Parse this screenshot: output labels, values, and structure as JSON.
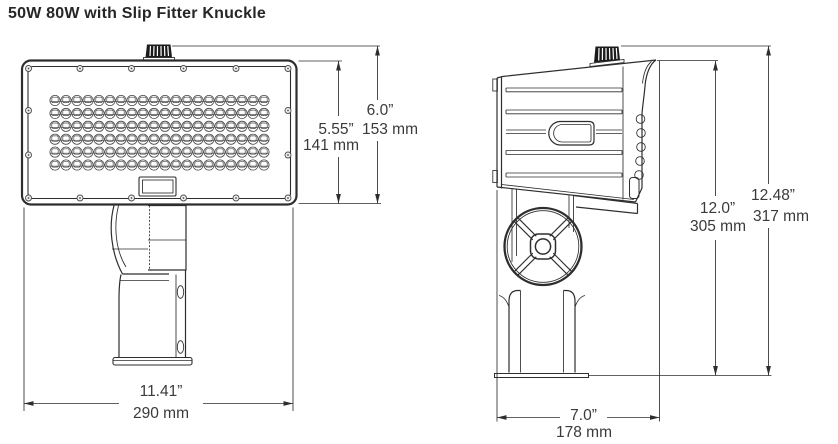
{
  "title": "50W 80W with Slip Fitter Knuckle",
  "colors": {
    "line": "#2e2e2e",
    "text": "#3a3a3a",
    "background": "#ffffff"
  },
  "front_view": {
    "led_grid": {
      "rows": 6,
      "cols": 20
    },
    "dims": {
      "housing_height_in": "5.55”",
      "housing_height_mm": "141 mm",
      "overall_height_in": "6.0”",
      "overall_height_mm": "153 mm",
      "width_in": "11.41”",
      "width_mm": "290 mm"
    }
  },
  "side_view": {
    "dims": {
      "mount_height_in": "12.0”",
      "mount_height_mm": "305 mm",
      "overall_height_in": "12.48”",
      "overall_height_mm": "317 mm",
      "depth_in": "7.0”",
      "depth_mm": "178 mm"
    }
  }
}
